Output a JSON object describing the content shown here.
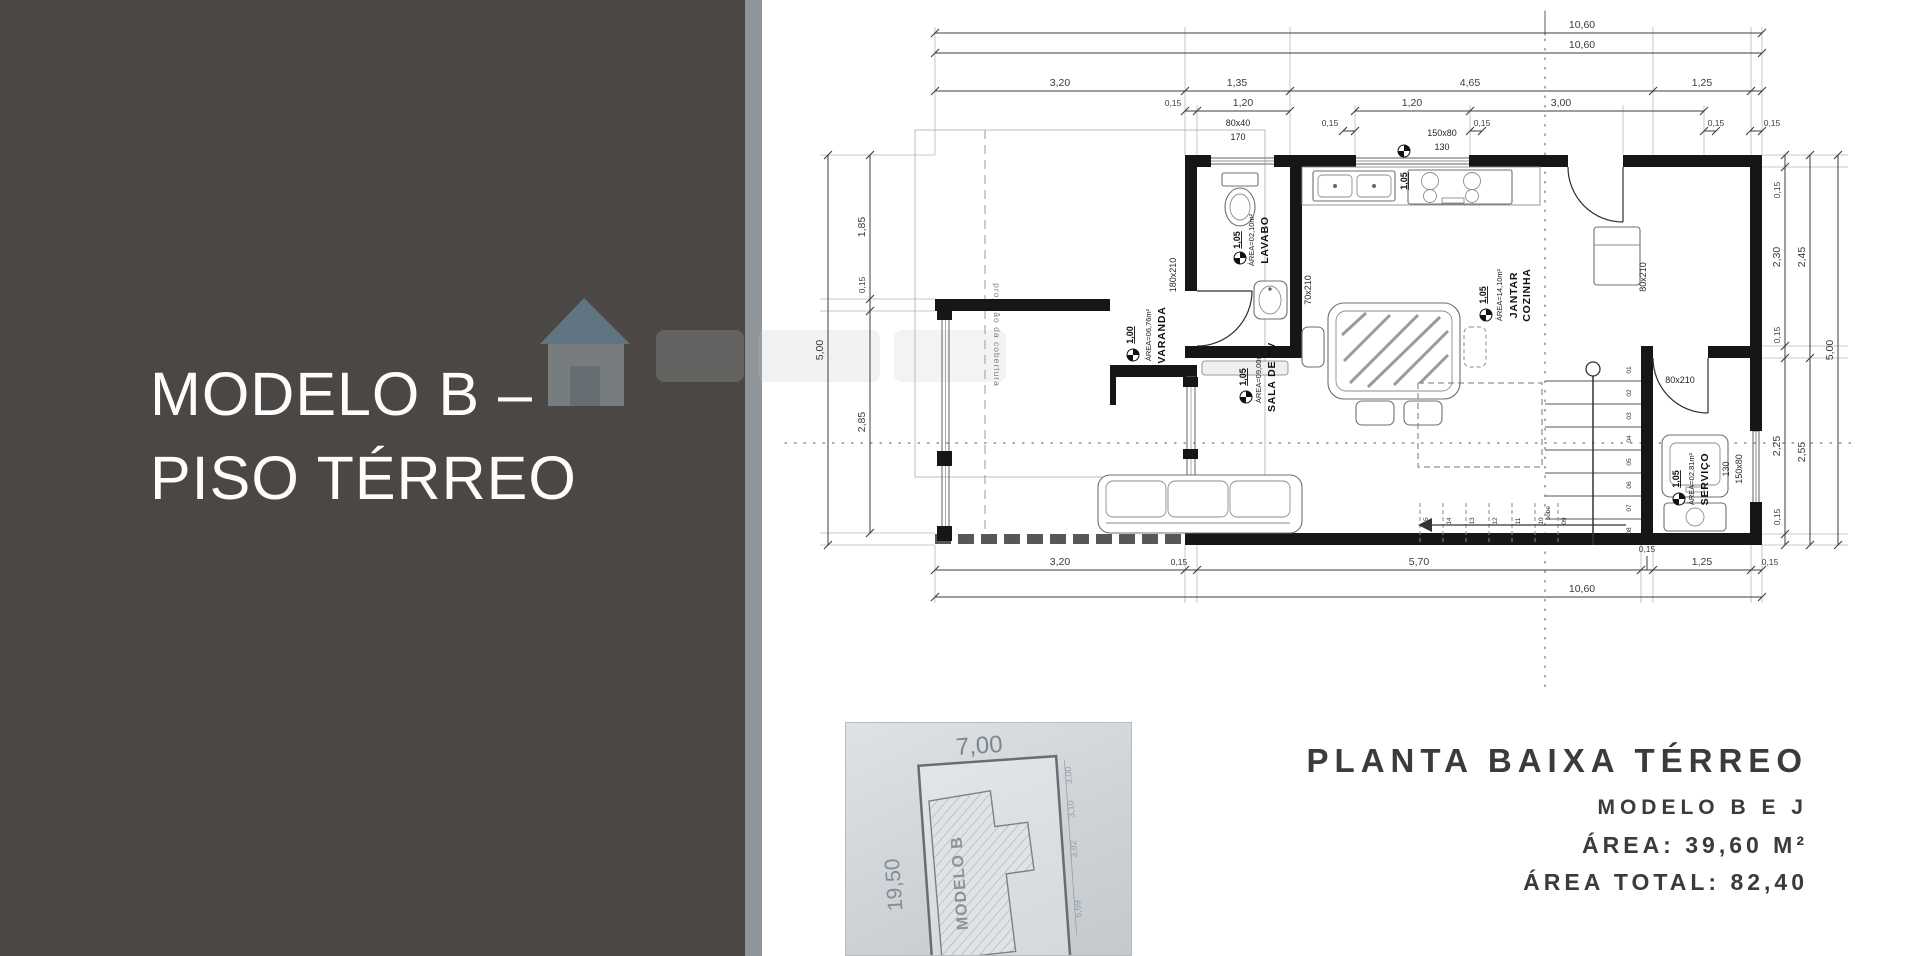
{
  "slide": {
    "title_line1": "MODELO B –",
    "title_line2": "PISO TÉRREO"
  },
  "caption": {
    "line1": "PLANTA BAIXA TÉRREO",
    "line2": "MODELO B E J",
    "line3": "ÁREA: 39,60 M²",
    "line4": "ÁREA TOTAL: 82,40"
  },
  "site_plan": {
    "top_dim": "7,00",
    "left_dim": "19,50",
    "building_label": "MODELO B",
    "side_dims": [
      "3,00",
      "3,10",
      "3,92",
      "6,69"
    ]
  },
  "plan": {
    "dims": {
      "top_total_1": "10,60",
      "top_total_2": "10,60",
      "top_row": [
        "3,20",
        "1,35",
        "4,65",
        "1,25"
      ],
      "top_sub": [
        "0,15",
        "1,20",
        "1,20",
        "3,00"
      ],
      "top_sub2": [
        "0,15",
        "0,15",
        "0,15",
        "0,15"
      ],
      "bottom_row": [
        "3,20",
        "0,15",
        "5,70",
        "0,15",
        "1,25",
        "0,15"
      ],
      "bottom_total": "10,60",
      "left_total": "5,00",
      "left_row": [
        "1,85",
        "0,15",
        "2,85"
      ],
      "right_inner": [
        "0,15",
        "2,30",
        "0,15",
        "2,25",
        "0,15"
      ],
      "right_outer": [
        "2,45",
        "2,55"
      ],
      "right_total": "5,00"
    },
    "openings": {
      "win_lavabo_size": "80x40",
      "win_lavabo_h": "170",
      "win_kitchen_size": "150x80",
      "win_kitchen_h": "130",
      "win_kitchen_level": "1,05",
      "door_varanda": "180x210",
      "door_lavabo": "70x210",
      "door_entry": "80x210",
      "door_servico": "80x210",
      "win_servico_size": "150x80",
      "win_servico_h": "130"
    },
    "rooms": {
      "varanda": {
        "name": "VARANDA",
        "area": "ÁREA=06,76m²",
        "level": "1,00"
      },
      "lavabo": {
        "name": "LAVABO",
        "area": "ÁREA=02,10m²",
        "level": "1,05"
      },
      "cozinha": {
        "name1": "COZINHA",
        "name2": "JANTAR",
        "area": "ÁREA=14,10m²",
        "level": "1,05"
      },
      "sala": {
        "name": "SALA DE TV",
        "area": "ÁREA=09,00m²",
        "level": "1,05"
      },
      "servico": {
        "name": "SERVIÇO",
        "area": "ÁREA=02,81m²",
        "level": "1,05"
      }
    },
    "stairs": {
      "sobe": "sobe",
      "up": [
        "01",
        "02",
        "03",
        "04",
        "05",
        "06",
        "07",
        "08"
      ],
      "down": [
        "09",
        "10",
        "11",
        "12",
        "13",
        "14",
        "15"
      ]
    },
    "notes": {
      "roof_projection": "projeção da cobertura"
    }
  },
  "colors": {
    "panel": "#4a4744",
    "divider": "#90959a",
    "walls": "#161616",
    "watermark_blue": "#7fb3d8"
  }
}
